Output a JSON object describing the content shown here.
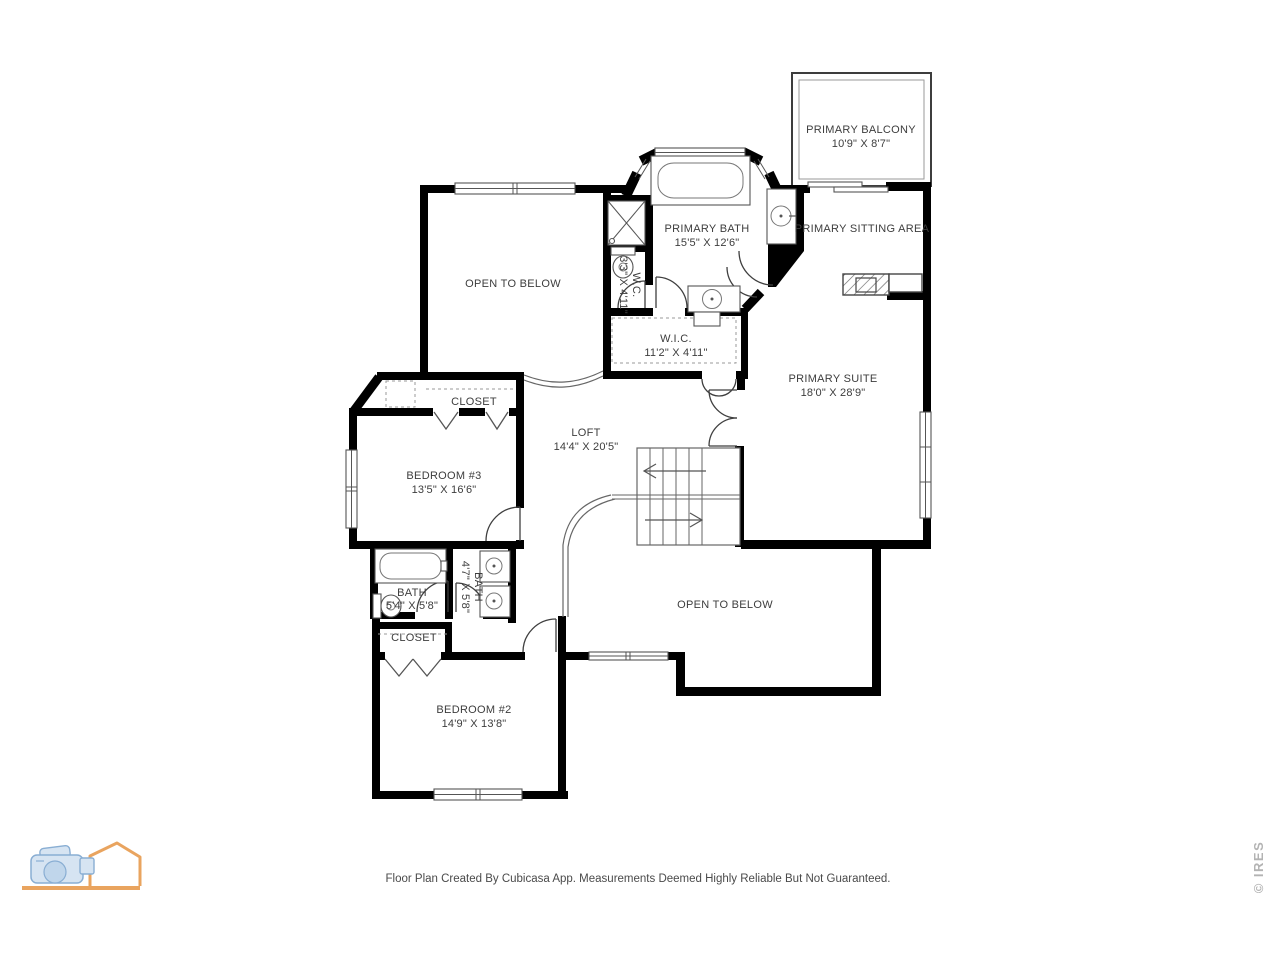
{
  "rooms": {
    "primary_balcony": {
      "label": "PRIMARY BALCONY",
      "dims": "10'9\" X 8'7\""
    },
    "primary_sitting_area": {
      "label": "PRIMARY SITTING AREA"
    },
    "primary_bath": {
      "label": "PRIMARY BATH",
      "dims": "15'5\" X 12'6\""
    },
    "wc": {
      "label": "W.C.",
      "dims": "3'3\" X 4'11\""
    },
    "wic": {
      "label": "W.I.C.",
      "dims": "11'2\" X 4'11\""
    },
    "open_to_below_upper": {
      "label": "OPEN TO BELOW"
    },
    "primary_suite": {
      "label": "PRIMARY SUITE",
      "dims": "18'0\" X 28'9\""
    },
    "closet_bedroom3": {
      "label": "CLOSET"
    },
    "bedroom3": {
      "label": "BEDROOM #3",
      "dims": "13'5\" X 16'6\""
    },
    "loft": {
      "label": "LOFT",
      "dims": "14'4\" X 20'5\""
    },
    "bath_hall": {
      "label": "BATH",
      "dims": "5'4\" X 5'8\""
    },
    "bath_inner": {
      "label": "BATH",
      "dims": "4'7\" X 5'8\""
    },
    "closet_bedroom2": {
      "label": "CLOSET"
    },
    "bedroom2": {
      "label": "BEDROOM #2",
      "dims": "14'9\" X 13'8\""
    },
    "open_to_below_lower": {
      "label": "OPEN TO BELOW"
    }
  },
  "footer": {
    "text": "Floor Plan Created By Cubicasa App. Measurements Deemed Highly Reliable But Not Guaranteed."
  },
  "watermark": {
    "text": "© IRES"
  },
  "colors": {
    "wall": "#000000",
    "label": "#3d3d3d",
    "watermark_gray": "#b3b3b3",
    "logo_orange": "#e9a45f",
    "logo_blue_fill": "#d6e4f2",
    "logo_blue_stroke": "#89aed3"
  }
}
